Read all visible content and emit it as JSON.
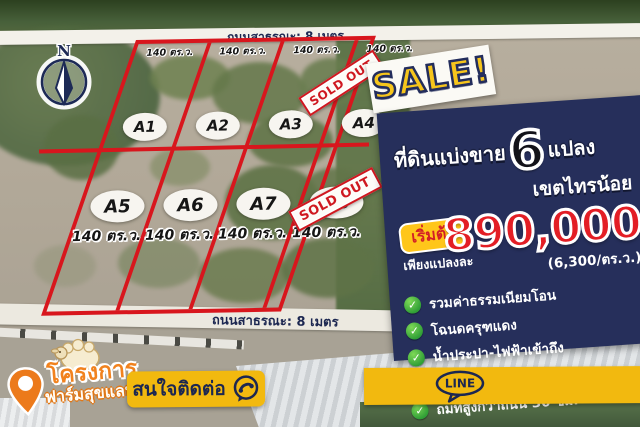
{
  "colors": {
    "accent_red": "#d8161d",
    "navy": "#262f5b",
    "yellow": "#f2b90f",
    "green_check": "#2f9e36",
    "orange": "#f1821e"
  },
  "top_road": {
    "label": "ถนนสาธรณะ: 8 เมตร"
  },
  "bottom_road": {
    "label": "ถนนสาธรณะ: 8 เมตร"
  },
  "compass": {
    "letter": "N"
  },
  "sale_banner": {
    "label": "SALE!"
  },
  "sold_out": {
    "label": "SOLD OUT"
  },
  "plots": {
    "top_row": [
      {
        "id": "A1",
        "area": "140 ตร.ว."
      },
      {
        "id": "A2",
        "area": "140 ตร.ว."
      },
      {
        "id": "A3",
        "area": "140 ตร.ว."
      },
      {
        "id": "A4",
        "area": "140 ตร.ว."
      }
    ],
    "bottom_row": [
      {
        "id": "A5",
        "area": "140 ตร.ว."
      },
      {
        "id": "A6",
        "area": "140 ตร.ว."
      },
      {
        "id": "A7",
        "area": "140 ตร.ว."
      },
      {
        "id": "A8",
        "area": "140 ตร.ว."
      }
    ]
  },
  "panel": {
    "headline_prefix": "ที่ดินแบ่งขาย",
    "headline_number": "6",
    "headline_suffix": "แปลง",
    "district": "เขตไทรน้อย",
    "price_badge": "เริ่มต้น",
    "price_prefix": "เพียงแปลงละ",
    "price": "890,000",
    "price_unit": "(6,300/ตร.ว.)",
    "features": [
      "รวมค่าธรรมเนียมโอน",
      "โฉนดครุฑแดง",
      "น้ำประปา-ไฟฟ้าเข้าถึง",
      "มีถนนสาธรณะ: 8 เมตร",
      "ถมที่สูงกว่าถนน 30 ซม."
    ],
    "check_glyph": "✓"
  },
  "logo": {
    "line1": "โครงการ",
    "line2": "ฟาร์มสุขแลนด์"
  },
  "contact": {
    "label": "สนใจติดต่อ"
  },
  "line_bar": {
    "label": "LINE"
  }
}
